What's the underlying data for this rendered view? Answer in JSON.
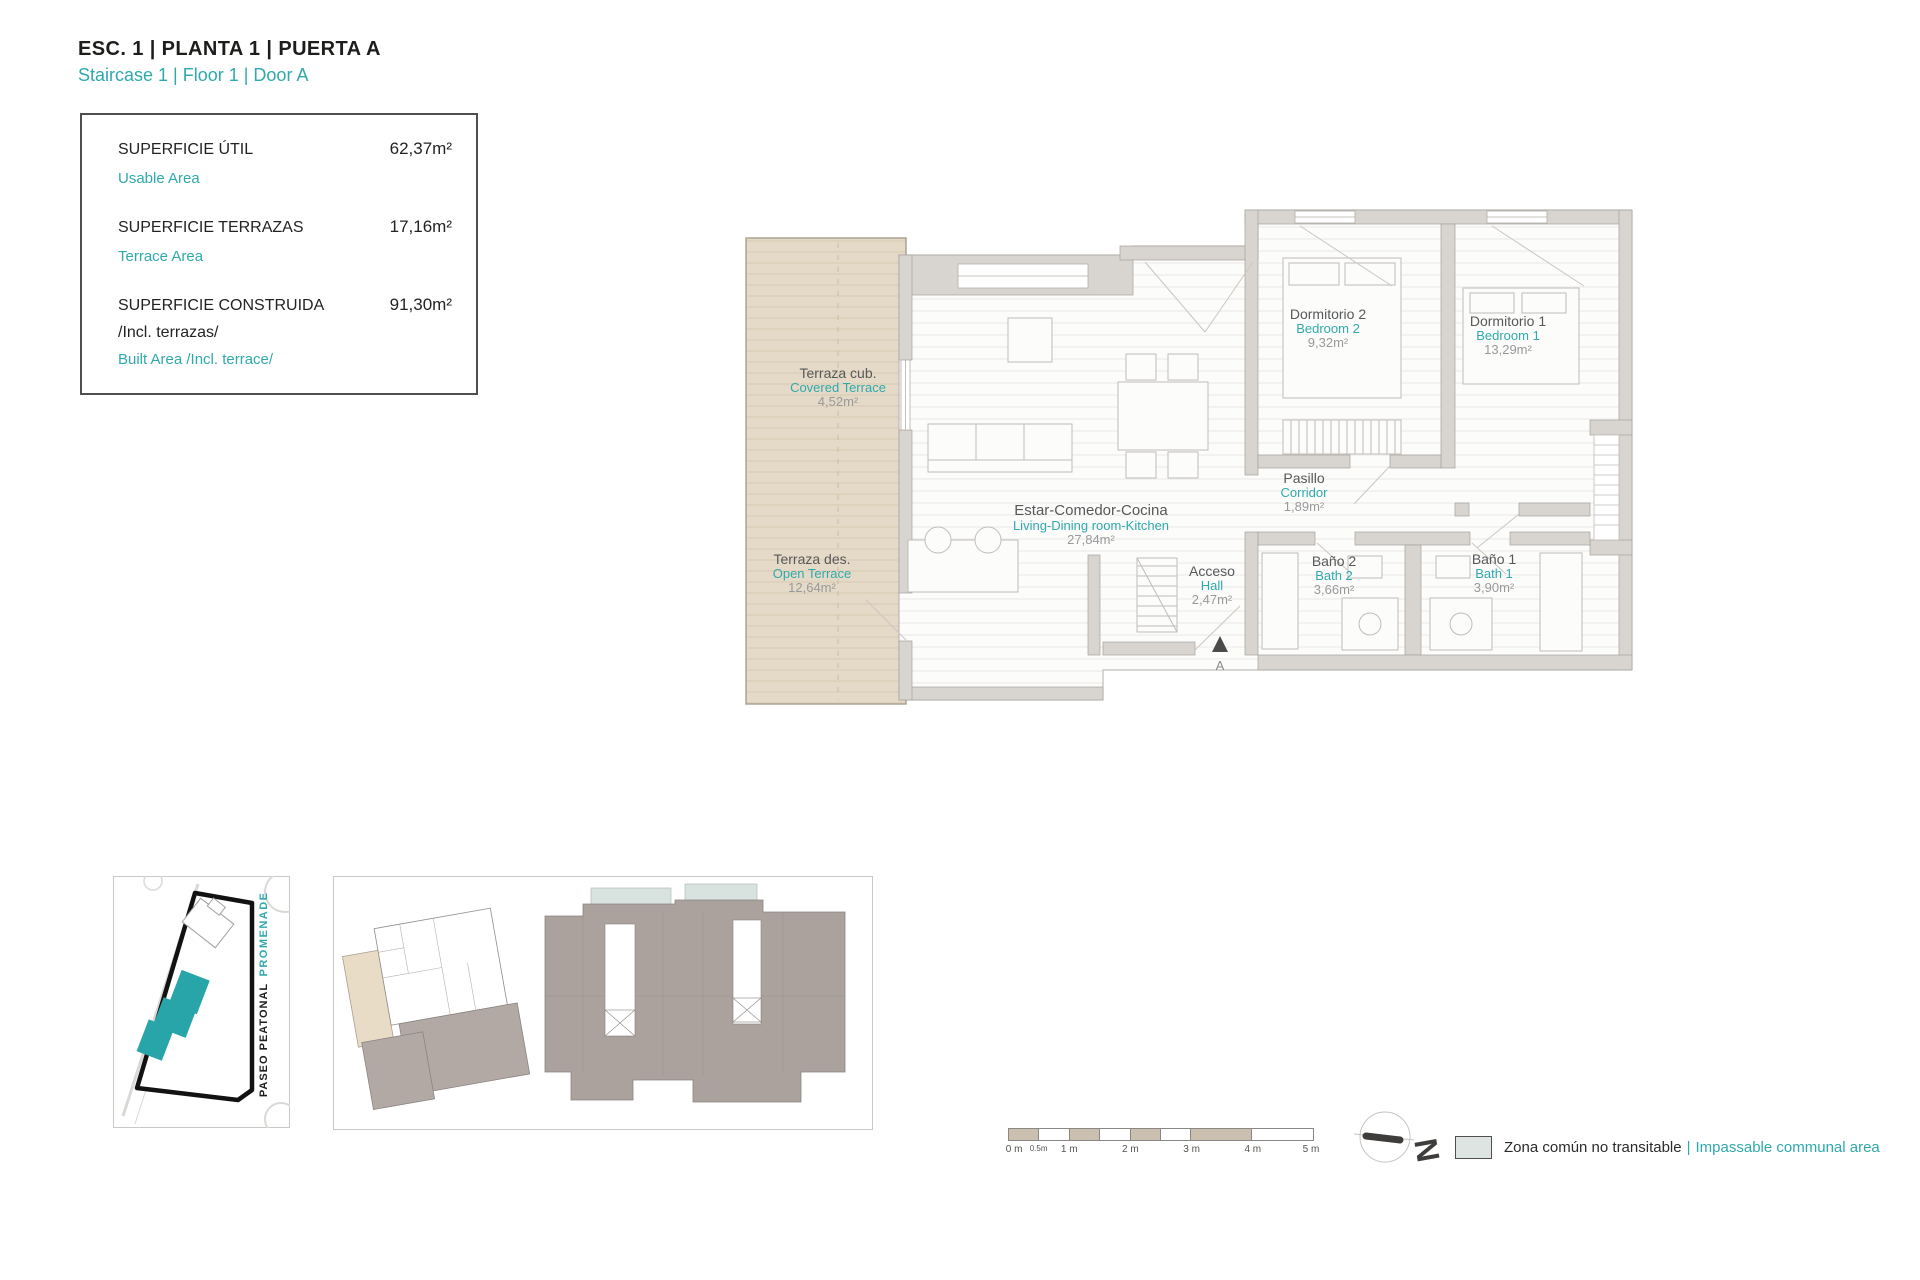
{
  "header": {
    "title": "ESC. 1 | PLANTA 1 | PUERTA A",
    "subtitle": "Staircase 1 | Floor 1 | Door A"
  },
  "areas_box": {
    "rows": [
      {
        "label": "SUPERFICIE ÚTIL",
        "label2": "",
        "sub": "Usable Area",
        "value": "62,37m²"
      },
      {
        "label": "SUPERFICIE TERRAZAS",
        "label2": "",
        "sub": "Terrace Area",
        "value": "17,16m²"
      },
      {
        "label": "SUPERFICIE CONSTRUIDA",
        "label2": "/Incl. terrazas/",
        "sub": "Built Area /Incl. terrace/",
        "value": "91,30m²"
      }
    ]
  },
  "rooms": [
    {
      "name_es": "Terraza cub.",
      "name_en": "Covered Terrace",
      "area": "4,52m²"
    },
    {
      "name_es": "Terraza des.",
      "name_en": "Open Terrace",
      "area": "12,64m²"
    },
    {
      "name_es": "Estar-Comedor-Cocina",
      "name_en": "Living-Dining room-Kitchen",
      "area": "27,84m²"
    },
    {
      "name_es": "Dormitorio 2",
      "name_en": "Bedroom 2",
      "area": "9,32m²"
    },
    {
      "name_es": "Dormitorio 1",
      "name_en": "Bedroom 1",
      "area": "13,29m²"
    },
    {
      "name_es": "Pasillo",
      "name_en": "Corridor",
      "area": "1,89m²"
    },
    {
      "name_es": "Acceso",
      "name_en": "Hall",
      "area": "2,47m²"
    },
    {
      "name_es": "Baño 2",
      "name_en": "Bath 2",
      "area": "3,66m²"
    },
    {
      "name_es": "Baño 1",
      "name_en": "Bath 1",
      "area": "3,90m²"
    }
  ],
  "entrance": {
    "marker": "A"
  },
  "site_plan": {
    "street_top": "PROMENADE",
    "street_side": "PASEO PEATONAL"
  },
  "scale_bar": {
    "labels": [
      "0 m",
      "0.5m",
      "1 m",
      "2 m",
      "3 m",
      "4 m",
      "5 m"
    ]
  },
  "compass": {
    "label": "N"
  },
  "legend": {
    "text_es": "Zona común no transitable",
    "separator": "|",
    "text_en": "Impassable communal area"
  },
  "colors": {
    "accent": "#2fa9ad",
    "wall": "#d8d5d0",
    "terrace": "#e5dac7",
    "site_building": "#27a5a9"
  }
}
